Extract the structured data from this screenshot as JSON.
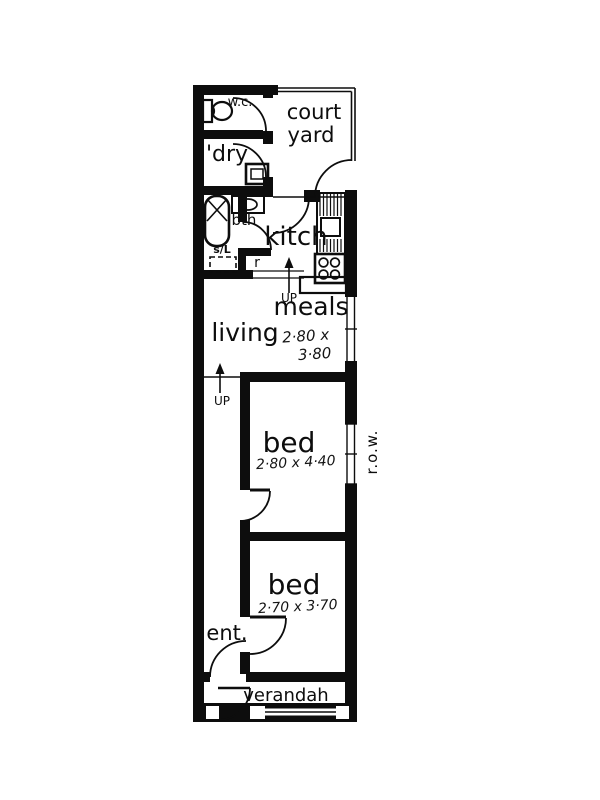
{
  "plan": {
    "colors": {
      "ink": "#0d0d0d",
      "paper": "#ffffff"
    },
    "rooms": {
      "wc": "w.c.",
      "laundry": "l'dry",
      "courtyard_line1": "court",
      "courtyard_line2": "yard",
      "bath": "bth",
      "skylight": "s/L",
      "fridge_nook": "r",
      "kitchen": "kitch",
      "living": "living",
      "meals": "meals",
      "bed1": "bed",
      "bed2": "bed",
      "entrance": "ent.",
      "verandah": "verandah"
    },
    "dimensions": {
      "meals_line1": "2·80 x",
      "meals_line2": "3·80",
      "bed1": "2·80 x 4·40",
      "bed2": "2·70 x 3·70"
    },
    "annotations": {
      "up_step_kitchen": "UP",
      "up_step_hall": "UP",
      "right_of_way": "r.o.w."
    }
  }
}
